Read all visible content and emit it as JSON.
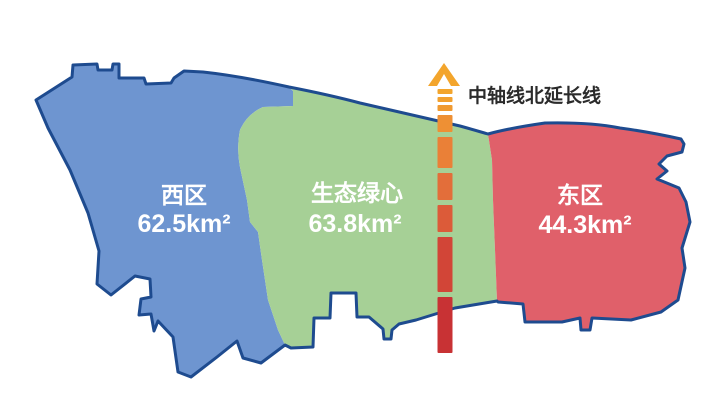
{
  "map": {
    "background": "#FFFFFF",
    "border_color": "#1E4B8F",
    "label_color": "#FFFFFF"
  },
  "regions": {
    "west": {
      "name": "西区",
      "area": "62.5km²",
      "color": "#6E95D0"
    },
    "center": {
      "name": "生态绿心",
      "area": "63.8km²",
      "color": "#A6D096"
    },
    "east": {
      "name": "东区",
      "area": "44.3km²",
      "color": "#E0606A"
    }
  },
  "axis": {
    "label": "中轴线北延长线",
    "label_color": "#2B2B2B",
    "arrow_color": "#F3A52C",
    "segment_colors": [
      "#F3A52C",
      "#F2A02E",
      "#F09A31",
      "#EE9034",
      "#EA8037",
      "#E36E3A",
      "#DC5B39",
      "#D24537",
      "#C83234"
    ]
  }
}
